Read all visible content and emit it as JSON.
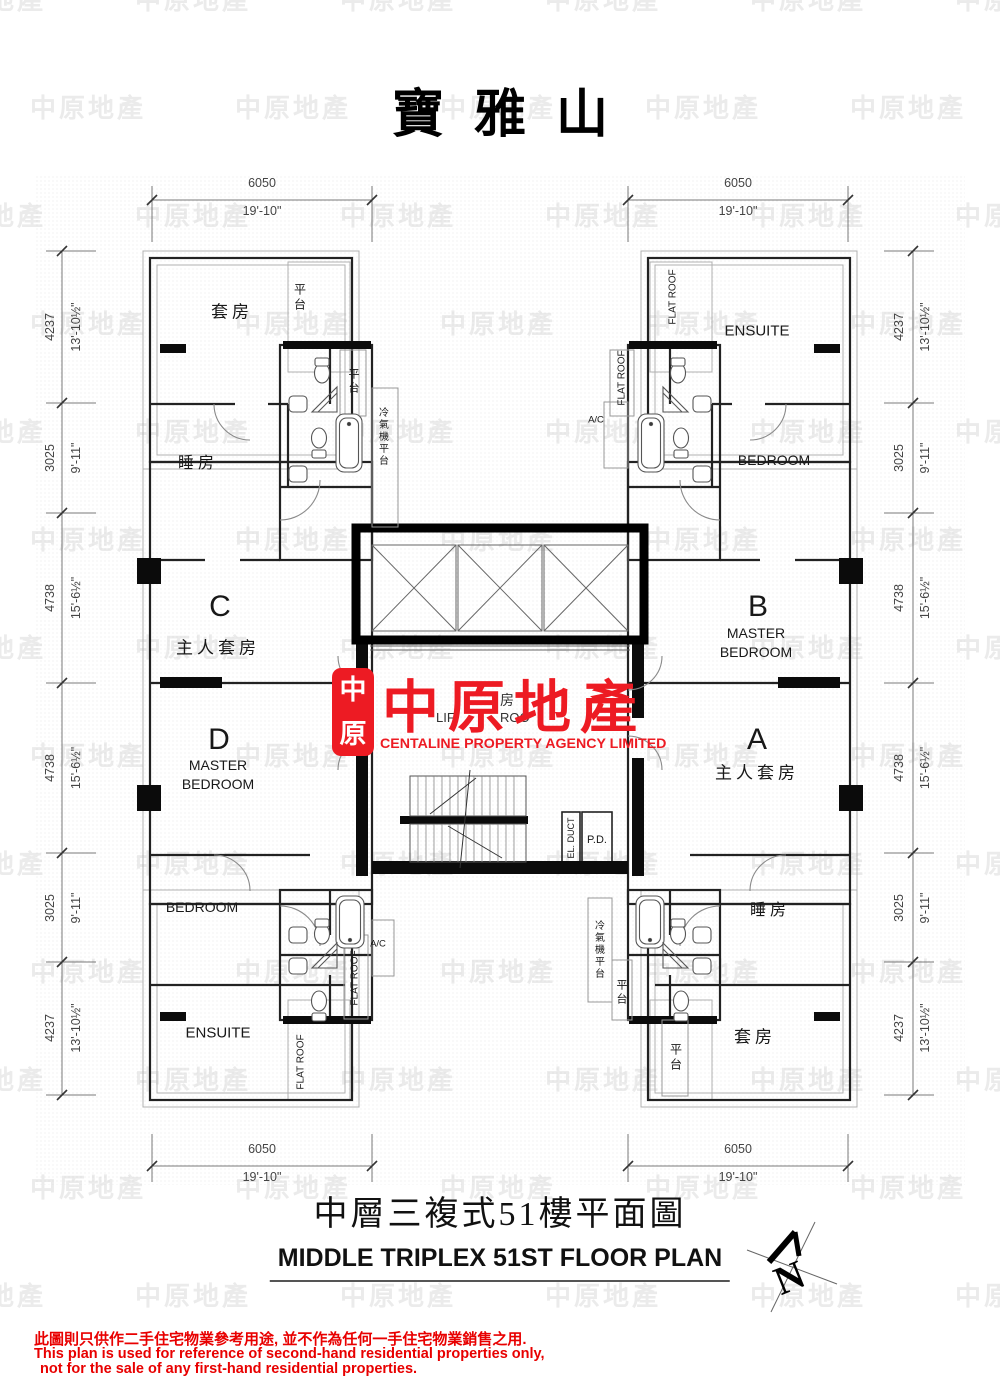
{
  "title": "寶雅山",
  "watermark": {
    "text": "中原地產"
  },
  "logo": {
    "seal_char_top": "中",
    "seal_char_bottom": "原",
    "name_cn": "中原地產",
    "name_en": "CENTALINE PROPERTY AGENCY LIMITED",
    "red": "#ed1b23"
  },
  "plan": {
    "units": {
      "c": {
        "id": "C",
        "room": "主人套房",
        "suite": "套房",
        "bedroom": "睡房",
        "balcony1": "平台",
        "balcony2": "平台"
      },
      "d": {
        "id": "D",
        "master1": "MASTER",
        "master2": "BEDROOM",
        "bedroom": "BEDROOM",
        "ensuite": "ENSUITE",
        "flatroof1": "FLAT ROOF",
        "flatroof2": "FLAT ROOF"
      },
      "b": {
        "id": "B",
        "master1": "MASTER",
        "master2": "BEDROOM",
        "bedroom": "BEDROOM",
        "ensuite": "ENSUITE",
        "flatroof1": "FLAT ROOF",
        "flatroof2": "FLAT ROOF"
      },
      "a": {
        "id": "A",
        "room": "主人套房",
        "suite": "套房",
        "bedroom": "睡房",
        "balcony1": "平台",
        "balcony2": "平台"
      }
    },
    "core": {
      "el_duct": "EL. DUCT",
      "pd": "P.D.",
      "ac_top": "A/C",
      "ac_bottom": "A/C",
      "acp_top": "冷氣機平台",
      "acp_bottom": "冷氣機平台",
      "lobby_fragment_cn": "房",
      "lobby_fragment_en_1": "LIF",
      "lobby_fragment_en_2": "ROO"
    }
  },
  "dimensions": {
    "top_left": {
      "metric": "6050",
      "imperial": "19'-10\""
    },
    "top_right": {
      "metric": "6050",
      "imperial": "19'-10\""
    },
    "bottom_left": {
      "metric": "6050",
      "imperial": "19'-10\""
    },
    "bottom_right": {
      "metric": "6050",
      "imperial": "19'-10\""
    },
    "left": [
      {
        "metric": "4237",
        "imperial": "13'-10½\""
      },
      {
        "metric": "3025",
        "imperial": "9'-11\""
      },
      {
        "metric": "4738",
        "imperial": "15'-6½\""
      },
      {
        "metric": "4738",
        "imperial": "15'-6½\""
      },
      {
        "metric": "3025",
        "imperial": "9'-11\""
      },
      {
        "metric": "4237",
        "imperial": "13'-10½\""
      }
    ],
    "right": [
      {
        "metric": "4237",
        "imperial": "13'-10½\""
      },
      {
        "metric": "3025",
        "imperial": "9'-11\""
      },
      {
        "metric": "4738",
        "imperial": "15'-6½\""
      },
      {
        "metric": "4738",
        "imperial": "15'-6½\""
      },
      {
        "metric": "3025",
        "imperial": "9'-11\""
      },
      {
        "metric": "4237",
        "imperial": "13'-10½\""
      }
    ]
  },
  "footer": {
    "title_cn": "中層三複式51樓平面圖",
    "title_en": "MIDDLE TRIPLEX 51ST FLOOR PLAN"
  },
  "disclaimer": {
    "line_cn": "此圖則只供作二手住宅物業參考用途, 並不作為任何一手住宅物業銷售之用.",
    "line_en_1": "This plan is used for reference of second-hand residential properties only,",
    "line_en_2": "not for the sale of any first-hand residential properties."
  },
  "north": {
    "label": "N"
  }
}
